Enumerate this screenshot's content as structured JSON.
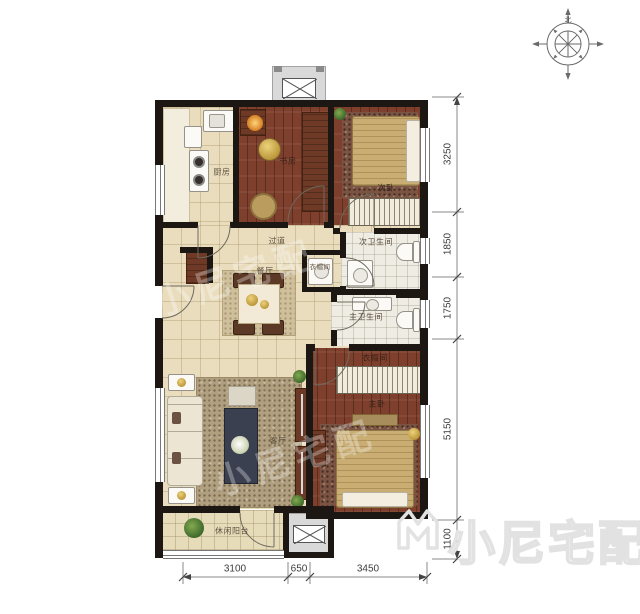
{
  "compass": {
    "north_label": "北"
  },
  "watermark": {
    "brand": "小尼宅配"
  },
  "rooms": {
    "kitchen": {
      "label": "厨房"
    },
    "study": {
      "label": "书房"
    },
    "bedroom2": {
      "label": "次卧"
    },
    "bath2": {
      "label": "次卫生间"
    },
    "hallway": {
      "label": "过道"
    },
    "closet": {
      "label": "衣帽间"
    },
    "dining": {
      "label": "餐厅"
    },
    "master_bath": {
      "label": "主卫生间"
    },
    "wardrobe": {
      "label": "衣帽间"
    },
    "master_bedroom": {
      "label": "主卧"
    },
    "living": {
      "label": "客厅"
    },
    "balcony": {
      "label": "休闲阳台"
    }
  },
  "dimensions": {
    "bottom": [
      "3100",
      "650",
      "3450"
    ],
    "right": [
      "3250",
      "1850",
      "1750",
      "5150",
      "1100"
    ]
  },
  "colors": {
    "wall": "#1c1713",
    "wood": "#7e3f2c",
    "tile": "#e9ddbd",
    "gold": "#c9a227"
  }
}
